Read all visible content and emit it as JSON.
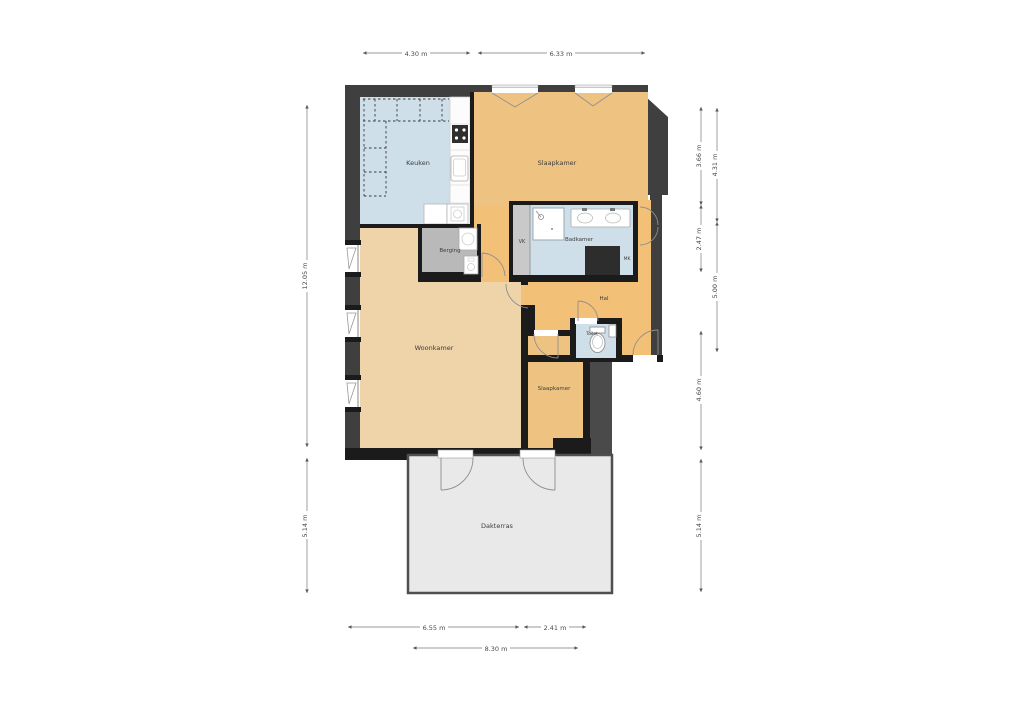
{
  "plan": {
    "rooms": {
      "keuken": "Keuken",
      "slaapkamer_top": "Slaapkamer",
      "berging": "Berging",
      "vk": "VK",
      "badkamer": "Badkamer",
      "mk": "MK",
      "hal": "Hal",
      "toilet": "Toilet",
      "woonkamer": "Woonkamer",
      "slaapkamer_bottom": "Slaapkamer",
      "dakterras": "Dakterras"
    },
    "dimensions": {
      "top_left": "4.30 m",
      "top_right": "6.33 m",
      "left_upper": "12.05 m",
      "left_lower": "5.14 m",
      "right_inner_1": "3.66 m",
      "right_inner_2": "2.47 m",
      "right_inner_3": "4.60 m",
      "right_inner_4": "5.14 m",
      "right_outer_1": "4.31 m",
      "right_outer_2": "5.00 m",
      "bottom_1": "6.55 m",
      "bottom_2": "2.41 m",
      "bottom_3": "8.30 m"
    },
    "colors": {
      "wall_dark": "#3f3f3f",
      "wall_black": "#1b1b1b",
      "roof_gray": "#4a4a4a",
      "floor_kitchen": "#cfdfe9",
      "floor_bath": "#cfdfe9",
      "floor_bedroom": "#eec382",
      "floor_hall": "#f2c077",
      "floor_living": "#eed4a8",
      "floor_storage": "#b9b9b9",
      "floor_vk": "#c9c9c9",
      "floor_terrace": "#e9e9e9"
    }
  }
}
